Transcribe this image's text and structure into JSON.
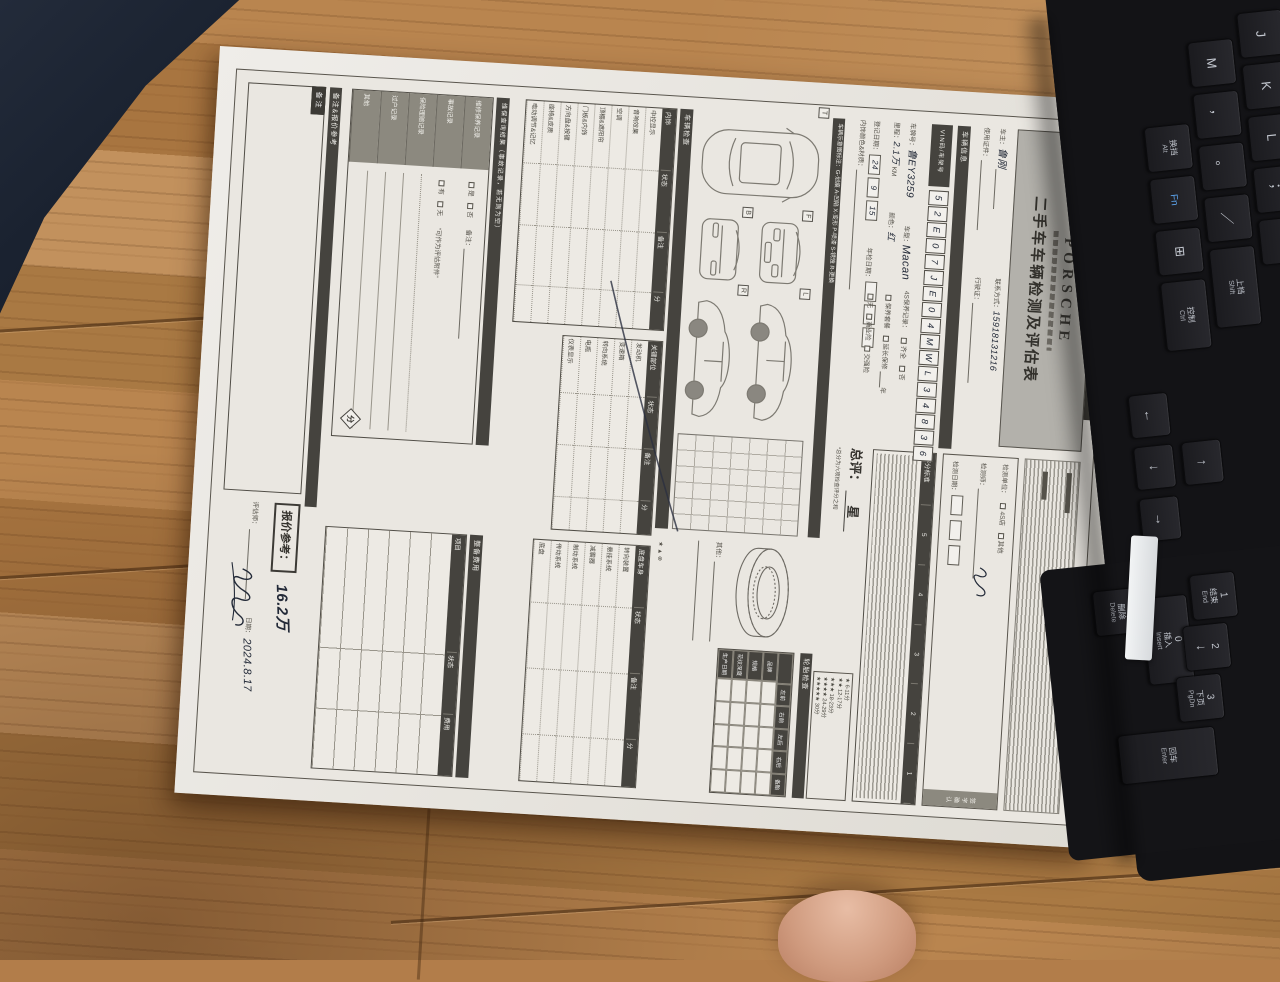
{
  "form": {
    "header": {
      "brand": "PORSCHE",
      "title": "二手车车辆检测及评估表"
    },
    "owner": {
      "f1_label": "车主：",
      "f1_value": "鲁刚",
      "f2_label": "联系方式：",
      "f2_value": "15918131216",
      "f3_label": "使用证件：",
      "f3_value": "",
      "f4_label": "行驶证：",
      "f4_value": ""
    },
    "vehicle": {
      "section": "车辆信息",
      "vin_label": "VIN码/车架号",
      "vin": [
        "5",
        "2",
        "E",
        "0",
        "7",
        "J",
        "E",
        "0",
        "4",
        "M",
        "W",
        "L",
        "3",
        "4",
        "8",
        "3",
        "6"
      ],
      "plate_label": "车牌号：",
      "plate": "鲁EY3259",
      "model_label": "车型：",
      "model": "Macan",
      "mileage_label": "里程：",
      "mileage": "2.1万",
      "mileage_unit": "KM",
      "color_label": "颜色：",
      "color": "红",
      "reg_label": "登记日期：",
      "reg_date": [
        "24",
        "9",
        "15"
      ],
      "insp_label": "年检日期：",
      "insp_date": [
        " ",
        " ",
        " "
      ],
      "interior_label": "内饰颜色&材质：",
      "maint_label": "4S保养记录：",
      "maint_opts": [
        "齐全",
        "否"
      ],
      "maint2_opts": [
        "保养套餐",
        "延长保修"
      ],
      "maint2_suffix": "年",
      "ins_opts": [
        "无",
        "商业险",
        "交强险"
      ]
    },
    "exterior": {
      "legend": "车辆示意图标注：G-划痕  A-凹陷  X-变形  P-喷漆  S-锈蚀  R-更换",
      "view_top": "T",
      "view_front": "F",
      "view_back": "B",
      "view_left": "L",
      "view_right": "R",
      "tire_section": "轮胎检查",
      "tire_cols": [
        "左前",
        "右前",
        "左后",
        "右后",
        "备胎"
      ],
      "tire_rows": [
        "品牌",
        "规格",
        "花纹深度",
        "生产日期"
      ],
      "other_label": "其他："
    },
    "check": {
      "section": "车辆检查",
      "col_status": "状态",
      "col_note": "备注",
      "col_score": "分",
      "symbols": "★ ▲ ⊗",
      "t1_name": "内饰",
      "t1_rows": [
        "中控显示",
        "音响效果",
        "空调",
        "顶棚&遮阳帘",
        "门板&内饰",
        "方向盘&按键",
        "座椅&皮质",
        "电动调节&记忆"
      ],
      "t2_name": "关键部位",
      "t2_rows": [
        "发动机",
        "变速箱",
        "转向系统",
        "电瓶",
        "仪表显示"
      ],
      "t3_name": "底盘车身",
      "t3_rows": [
        "转向装置",
        "悬挂系统",
        "减震器",
        "制动系统",
        "传动系统",
        "底盘"
      ]
    },
    "query": {
      "section": "维保查询结果（事故记录，若无则为空）",
      "rows": [
        "维修保养记录",
        "事故记录",
        "保险理赔记录",
        "过户记录",
        "其他"
      ],
      "c1_opts": [
        "是",
        "否"
      ],
      "c1_note": "备注：",
      "c2_opts": [
        "有",
        "无"
      ],
      "c2_note": "“可作为评估附件”",
      "score": "分"
    },
    "recondition": {
      "section": "整备费用",
      "cols": [
        "项目",
        "状态",
        "费用"
      ]
    },
    "summary": {
      "unit_label": "检测单位：",
      "unit_opts": [
        "4S店",
        "其他"
      ],
      "inspector_label": "检测师：",
      "inspect_date_label": "检测日期：",
      "confirm_label": "签字确认",
      "rating_title": "评分标准",
      "rating_levels": [
        "5",
        "4",
        "3",
        "2",
        "1"
      ],
      "overall_label": "总评：",
      "overall_value": "星",
      "overall_note": "*总分为六项检查评分之和",
      "star_scale": [
        "★ 6-11分",
        "★★ 12-17分",
        "★★★ 18-23分",
        "★★★★ 24-29分",
        "★★★★★ 30分"
      ]
    },
    "notes": {
      "section": "备注&报价参考",
      "note_label": "备注",
      "quote_label": "报价参考：",
      "quote_value": "16.2万",
      "assessor_label": "评估师：",
      "date_label": "日期：",
      "date_value": "2024.8.17"
    }
  },
  "keyboard": {
    "row_home": [
      {
        "t": "J"
      },
      {
        "t": "K"
      },
      {
        "t": "L"
      },
      {
        "t": "；"
      },
      {
        "t": "‘"
      }
    ],
    "row_m": [
      {
        "t": "M"
      },
      {
        "t": "，"
      },
      {
        "t": "。"
      },
      {
        "t": "／"
      },
      {
        "zh": "上档",
        "en": "Shift",
        "cls": "w2"
      }
    ],
    "row_mod": [
      {
        "zh": "换挡",
        "en": "Alt"
      },
      {
        "t": "Fn",
        "cls": "fnk"
      },
      {
        "t": "⊞"
      },
      {
        "zh": "控制",
        "en": "Ctrl",
        "cls": "w3"
      }
    ],
    "arrows": [
      {
        "t": "↑",
        "cls": "a-up"
      },
      {
        "t": "←",
        "cls": "a-left"
      },
      {
        "t": "↓",
        "cls": "a-down"
      },
      {
        "t": "→",
        "cls": "a-right"
      }
    ],
    "numpad": [
      {
        "num": "0",
        "zh": "插入",
        "en": "Insert",
        "cls": "npk np-0"
      },
      {
        "num": "1",
        "zh": "结束",
        "en": "End",
        "cls": "npk np-1"
      },
      {
        "num": "2",
        "t": "↓",
        "cls": "npk np-2"
      },
      {
        "num": "3",
        "zh": "下页",
        "en": "PgDn",
        "cls": "npk np-3"
      },
      {
        "zh": "删除",
        "en": "Delete",
        "cls": "npk np-del"
      },
      {
        "zh": "回车",
        "en": "Enter",
        "cls": "npk np-ent"
      }
    ]
  }
}
